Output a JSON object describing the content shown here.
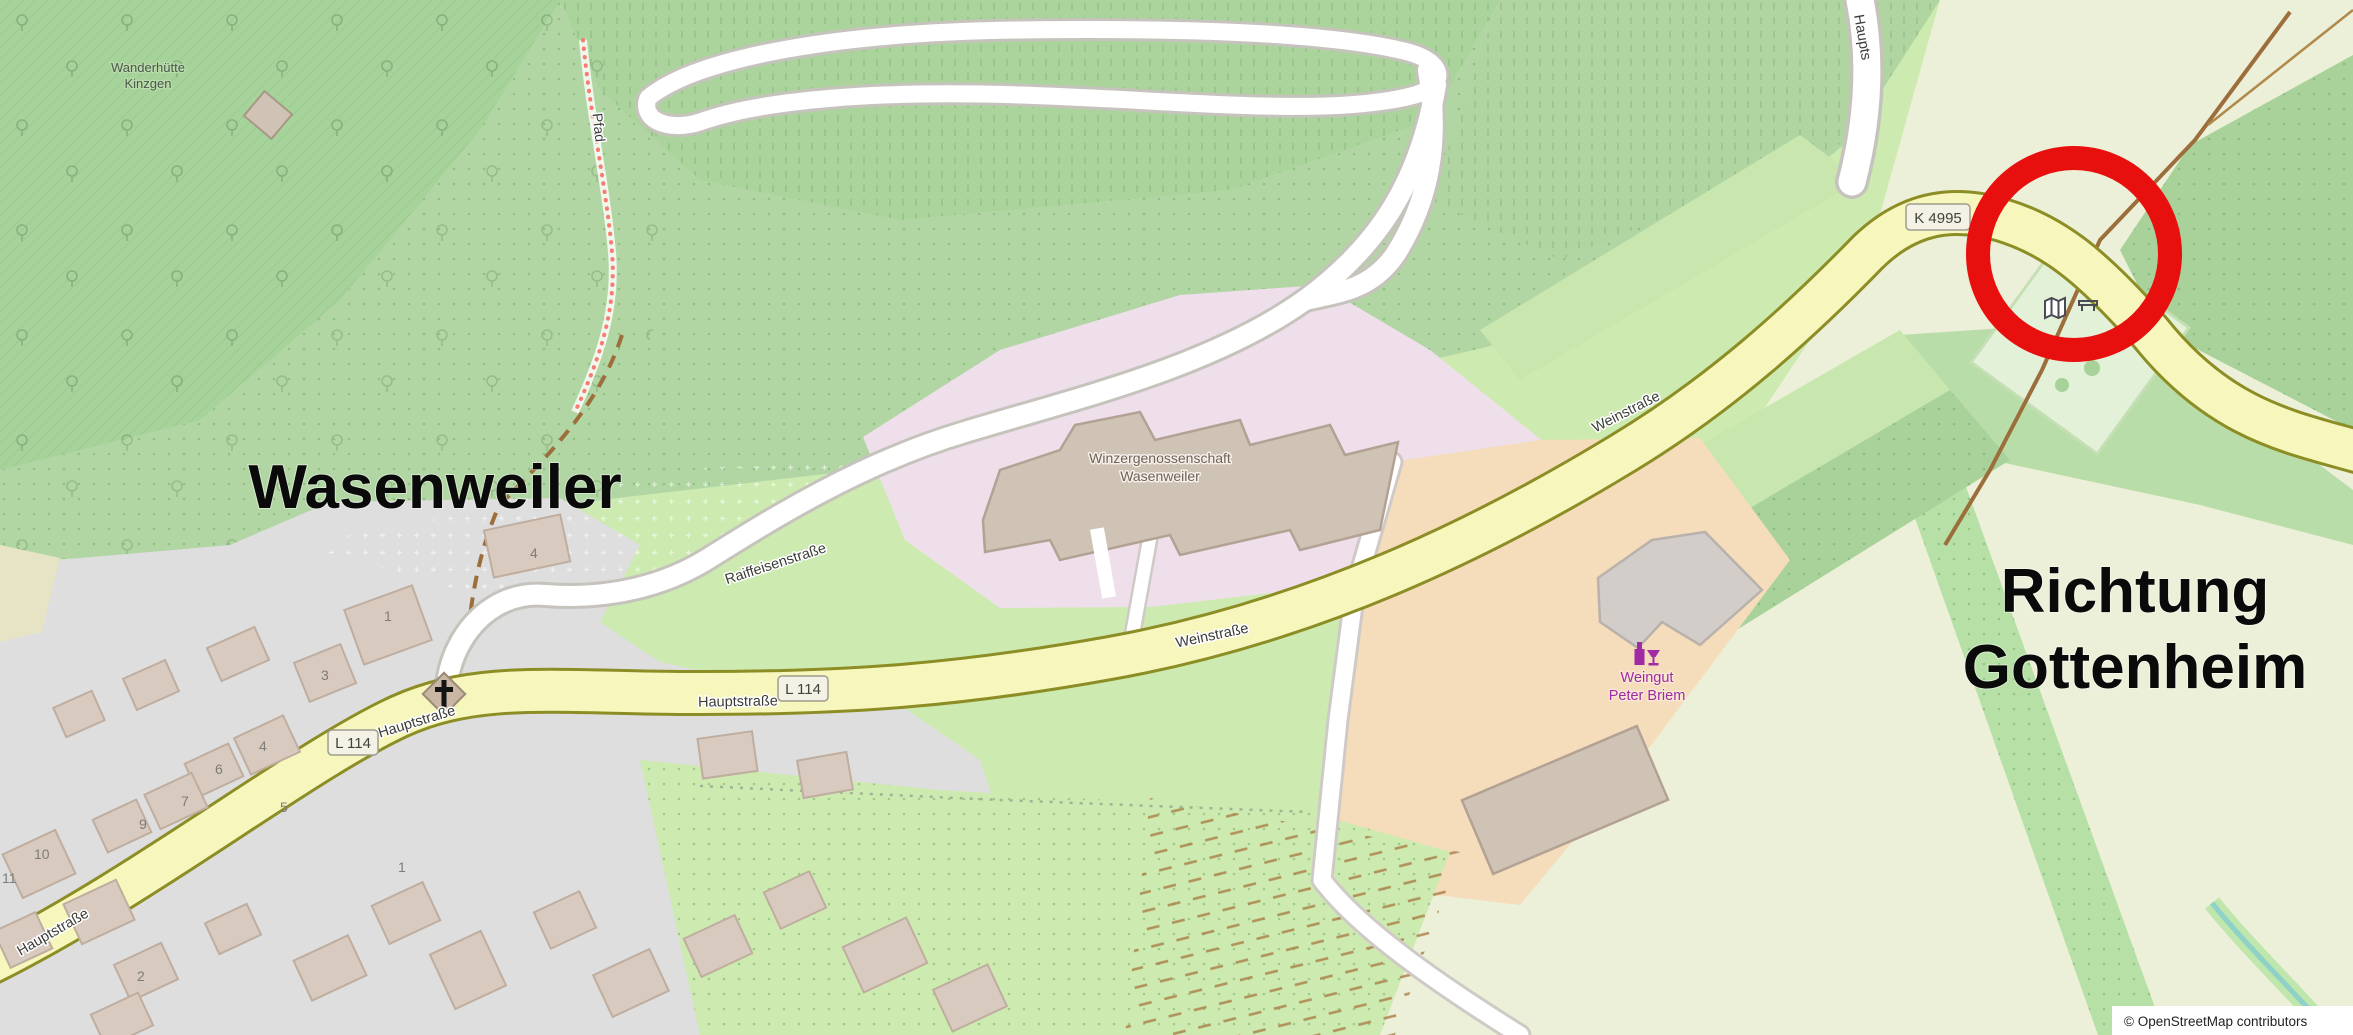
{
  "map": {
    "attribution": "© OpenStreetMap contributors",
    "annotations": {
      "town": "Wasenweiler",
      "direction_line1": "Richtung",
      "direction_line2": "Gottenheim"
    },
    "places": {
      "hut_line1": "Wanderhütte",
      "hut_line2": "Kinzgen",
      "winery_coop_line1": "Winzergenossenschaft",
      "winery_coop_line2": "Wasenweiler",
      "winery_line1": "Weingut",
      "winery_line2": "Peter Briem"
    },
    "streets": {
      "weinstrasse": "Weinstraße",
      "raiffeisenstrasse": "Raiffeisenstraße",
      "hauptstrasse": "Hauptstraße",
      "hauptstrasse_truncated": "Haupts",
      "pfad": "Pfad"
    },
    "routes": {
      "l114": "L 114",
      "k4995": "K 4995"
    },
    "house_numbers": [
      "4",
      "1",
      "3",
      "4",
      "6",
      "7",
      "9",
      "5",
      "10",
      "11",
      "1",
      "2"
    ],
    "icons": [
      "map-board-icon",
      "bench-icon",
      "picnic-table-icon",
      "church-cross-icon",
      "wine-shop-icon"
    ],
    "colors": {
      "annotation_red": "#e8100e",
      "annotation_black": "#0a0a0a",
      "road_yellow": "#f7f6bd",
      "road_casing_olive": "#8d8d26",
      "poi_purple": "#a12ba5",
      "industrial_pink": "#eedfeb",
      "farmland_orange": "#f5dcbb",
      "forest_green": "#a6d399",
      "grass_green": "#cdebb0",
      "field_pale": "#edf0d8",
      "residential_gray": "#dedede",
      "building_tan": "#cfc3b5"
    }
  }
}
